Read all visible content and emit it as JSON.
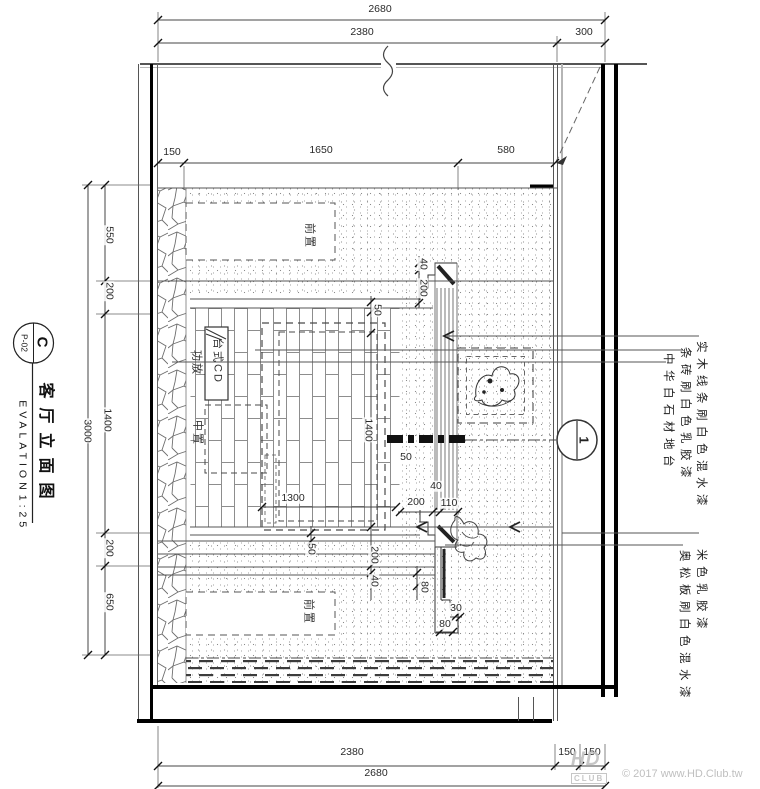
{
  "title_block": {
    "detail_letter": "C",
    "sheet_no": "P-02",
    "title": "客厅立面图",
    "title_en": "EVALATION",
    "scale": "1:25"
  },
  "section_marker": {
    "number": "1"
  },
  "watermark": {
    "logo_line1": "HD",
    "logo_line2": "CLUB",
    "copyright": "© 2017 www.HD.Club.tw"
  },
  "dims_h": [
    {
      "t": "2680",
      "x": 380,
      "y": 9
    },
    {
      "t": "2380",
      "x": 362,
      "y": 32
    },
    {
      "t": "300",
      "x": 584,
      "y": 32
    },
    {
      "t": "150",
      "x": 172,
      "y": 152
    },
    {
      "t": "1650",
      "x": 321,
      "y": 150
    },
    {
      "t": "580",
      "x": 506,
      "y": 150
    },
    {
      "t": "1300",
      "x": 293,
      "y": 498
    },
    {
      "t": "200",
      "x": 416,
      "y": 502
    },
    {
      "t": "110",
      "x": 449,
      "y": 503
    },
    {
      "t": "40",
      "x": 436,
      "y": 486
    },
    {
      "t": "50",
      "x": 406,
      "y": 457
    },
    {
      "t": "30",
      "x": 456,
      "y": 608
    },
    {
      "t": "80",
      "x": 445,
      "y": 624
    },
    {
      "t": "2380",
      "x": 352,
      "y": 752
    },
    {
      "t": "150",
      "x": 567,
      "y": 752
    },
    {
      "t": "150",
      "x": 592,
      "y": 752
    },
    {
      "t": "2680",
      "x": 376,
      "y": 773
    }
  ],
  "dims_v": [
    {
      "t": "550",
      "x": 109,
      "y": 235
    },
    {
      "t": "200",
      "x": 109,
      "y": 291
    },
    {
      "t": "1400",
      "x": 107,
      "y": 420
    },
    {
      "t": "200",
      "x": 109,
      "y": 548
    },
    {
      "t": "650",
      "x": 109,
      "y": 602
    },
    {
      "t": "3000",
      "x": 87,
      "y": 431
    },
    {
      "t": "50",
      "x": 377,
      "y": 310
    },
    {
      "t": "40",
      "x": 423,
      "y": 264
    },
    {
      "t": "200",
      "x": 423,
      "y": 288
    },
    {
      "t": "1400",
      "x": 368,
      "y": 430
    },
    {
      "t": "50",
      "x": 311,
      "y": 549
    },
    {
      "t": "200",
      "x": 374,
      "y": 555
    },
    {
      "t": "40",
      "x": 374,
      "y": 581
    },
    {
      "t": "80",
      "x": 424,
      "y": 587
    }
  ],
  "equipment": [
    {
      "t": "前置",
      "x": 309,
      "y": 236
    },
    {
      "t": "台式CD",
      "x": 217,
      "y": 361
    },
    {
      "t": "功放",
      "x": 196,
      "y": 363
    },
    {
      "t": "中置",
      "x": 197,
      "y": 433
    },
    {
      "t": "前置",
      "x": 308,
      "y": 612
    }
  ],
  "annotations": [
    {
      "t": "实木线条刷白色混水漆",
      "x": 700,
      "top": 341
    },
    {
      "t": "条砖刷白色乳胶漆",
      "x": 684,
      "top": 347
    },
    {
      "t": "中华白石材地台",
      "x": 667,
      "top": 353
    },
    {
      "t": "米色乳胶漆",
      "x": 700,
      "top": 549
    },
    {
      "t": "奥松板刷白色混水漆",
      "x": 683,
      "top": 550
    }
  ]
}
